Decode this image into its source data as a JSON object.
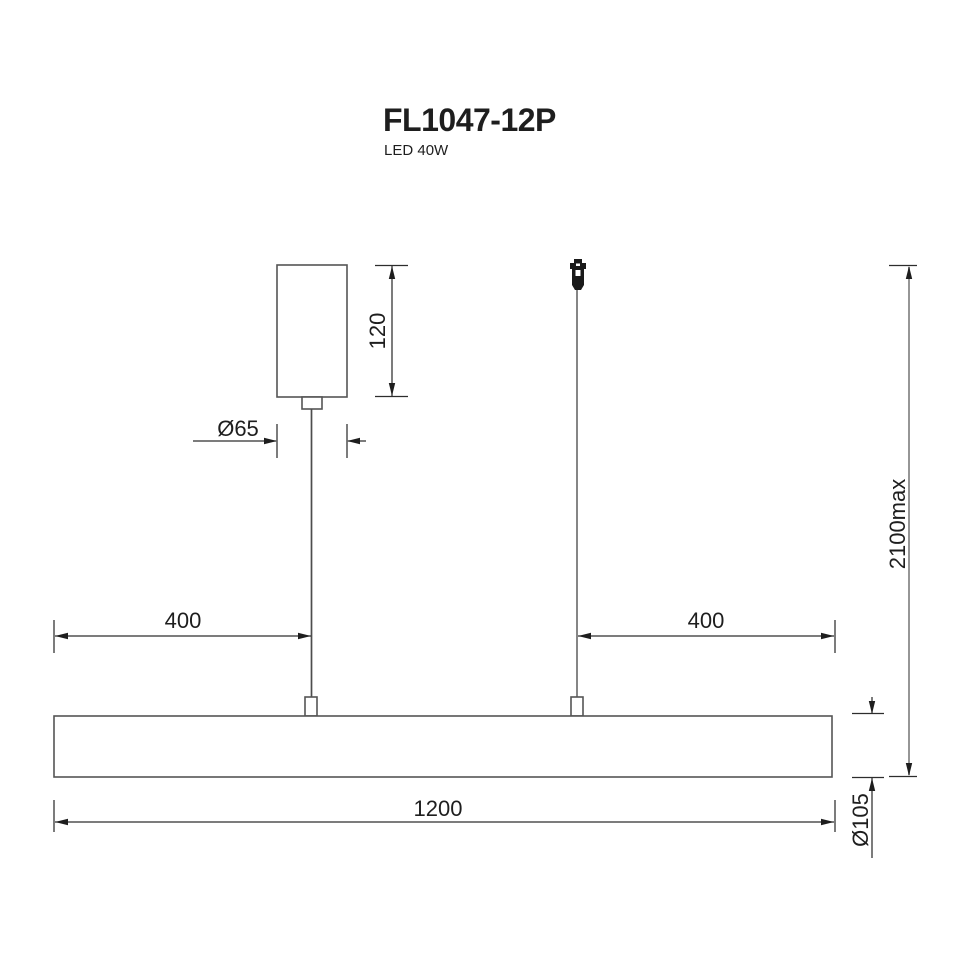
{
  "header": {
    "title": "FL1047-12P",
    "subtitle": "LED 40W"
  },
  "dimensions": {
    "canopy_height": "120",
    "canopy_diameter": "Ø65",
    "left_offset": "400",
    "right_offset": "400",
    "bar_length": "1200",
    "max_height": "2100max",
    "bar_diameter": "Ø105"
  },
  "colors": {
    "background": "#ffffff",
    "line": "#2d2d2d",
    "part_outline": "#555555",
    "cable": "#868686",
    "text": "#1e1e1e"
  }
}
